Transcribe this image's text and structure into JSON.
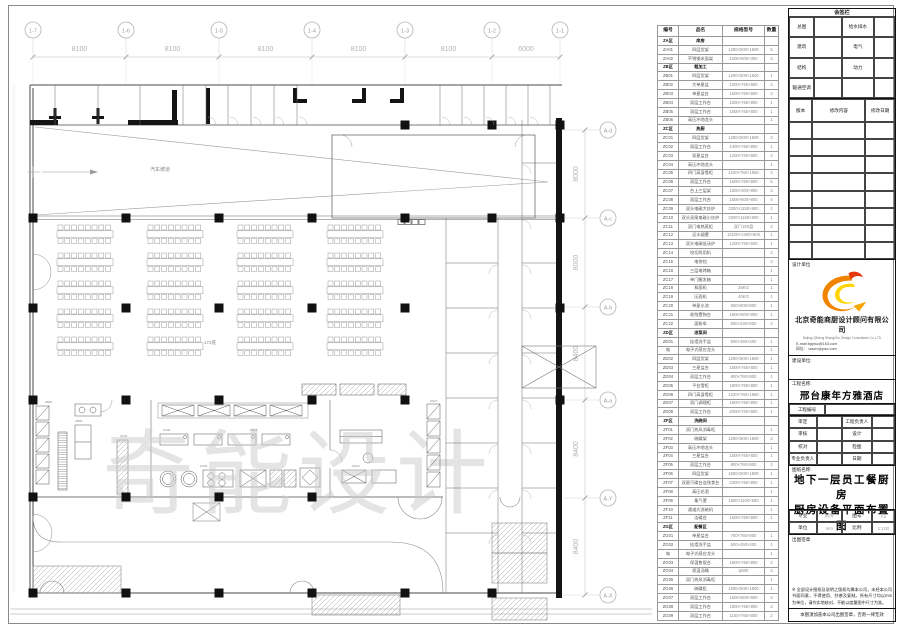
{
  "plan": {
    "grid_top": {
      "labels": [
        "1-7",
        "1-6",
        "1-5",
        "1-4",
        "1-3",
        "1-2",
        "1-1"
      ],
      "dims": [
        "8100",
        "8100",
        "8100",
        "8100",
        "8100",
        "6000"
      ]
    },
    "grid_right": {
      "labels": [
        "A-d",
        "A-c",
        "A-b",
        "A-a",
        "A-Y",
        "A-X"
      ],
      "dims": [
        "8000",
        "8000",
        "8400",
        "8400",
        "8400"
      ]
    },
    "watermark": "奇能设计",
    "ramp_label": "汽车坡道",
    "seats_label": "172座",
    "equip_tags": [
      "ZC06",
      "ZC09",
      "ZC05",
      "ZB02",
      "ZG03",
      "ZC12",
      "ZB03",
      "ZG07"
    ]
  },
  "schedule": {
    "headers": [
      "编号",
      "品名",
      "规格型号",
      "数量"
    ],
    "rows": [
      [
        "ZA区",
        "库房",
        "",
        "",
        true
      ],
      [
        "ZA01",
        "四层货架",
        "1200×500×1600",
        "5"
      ],
      [
        "ZA02",
        "不锈钢米面架",
        "1200×600×300",
        "4"
      ],
      [
        "ZB区",
        "粗加工",
        "",
        "",
        true
      ],
      [
        "ZB01",
        "四层货架",
        "1200×500×1600",
        "1"
      ],
      [
        "ZB02",
        "大单星盆",
        "1000×760×800",
        "4"
      ],
      [
        "ZB03",
        "单星盆台",
        "1500×760×800",
        "2"
      ],
      [
        "ZB04",
        "双层工作台",
        "1500×760×800",
        "1"
      ],
      [
        "ZB05",
        "双层工作台",
        "1800×760×800",
        "1"
      ],
      [
        "ZB06",
        "高压冲地龙头",
        "",
        "1"
      ],
      [
        "ZC区",
        "热厨",
        "",
        "",
        true
      ],
      [
        "ZC01",
        "四层货架",
        "1200×500×1600",
        "3"
      ],
      [
        "ZC02",
        "双层工作台",
        "1400×760×800",
        "1"
      ],
      [
        "ZC03",
        "双星盆台",
        "1200×760×800",
        "2"
      ],
      [
        "ZC04",
        "高压冲地龙头",
        "",
        "1"
      ],
      [
        "ZC05",
        "四门高身雪柜",
        "1220×760×1950",
        "4"
      ],
      [
        "ZC06",
        "双层工作台",
        "1600×760×800",
        "6"
      ],
      [
        "ZC07",
        "台上三层架",
        "1600×300×900",
        "3"
      ],
      [
        "ZC08",
        "双层工作台",
        "1600×600×800",
        "4"
      ],
      [
        "ZC09",
        "双头电磁大炒炉",
        "2200×1150×800",
        "1"
      ],
      [
        "ZC10",
        "双头双尾电磁小炒炉",
        "2200×1150×800",
        "1"
      ],
      [
        "ZC11",
        "双门电热蒸柜",
        "双门150盘",
        "2"
      ],
      [
        "ZC12",
        "运水烟罩",
        "14100×1300×600",
        "1"
      ],
      [
        "ZC13",
        "双头电磁低汤炉",
        "1200×750×600",
        "1"
      ],
      [
        "ZC14",
        "绞切两用机",
        "",
        "2"
      ],
      [
        "ZC15",
        "电饼铛",
        "",
        "2"
      ],
      [
        "ZC16",
        "三层电烤箱",
        "",
        "1"
      ],
      [
        "ZC17",
        "单门醒发箱",
        "",
        "1"
      ],
      [
        "ZC18",
        "和面机",
        "25KG",
        "1"
      ],
      [
        "ZC19",
        "压面机",
        "40KG",
        "1"
      ],
      [
        "ZC20",
        "单星水池",
        "600×600×800",
        "1"
      ],
      [
        "ZC21",
        "收残置物台",
        "1800×800×800",
        "1"
      ],
      [
        "ZC22",
        "面粉车",
        "500×430×600",
        "2"
      ],
      [
        "ZD区",
        "凉菜间",
        "",
        "",
        true
      ],
      [
        "ZD01",
        "挂墙洗手盆",
        "500×450×400",
        "1"
      ],
      [
        "电",
        "电子式感应龙头",
        "",
        "1"
      ],
      [
        "ZD02",
        "四层货架",
        "1200×500×1600",
        "1"
      ],
      [
        "ZD03",
        "三星盆台",
        "1800×760×800",
        "1"
      ],
      [
        "ZD04",
        "双层工作台",
        "900×760×800",
        "1"
      ],
      [
        "ZD05",
        "平台雪柜",
        "1800×760×800",
        "1"
      ],
      [
        "ZD06",
        "四门高身雪柜",
        "1220×760×1950",
        "1"
      ],
      [
        "ZD07",
        "双门调理柜",
        "1800×760×800",
        "1"
      ],
      [
        "ZD08",
        "双层工作台",
        "2000×760×800",
        "1"
      ],
      [
        "ZF区",
        "洗碗间",
        "",
        "",
        true
      ],
      [
        "ZF01",
        "双门热风消毒柜",
        "",
        "1"
      ],
      [
        "ZF02",
        "碗碟架",
        "1200×500×1800",
        "2"
      ],
      [
        "ZF03",
        "高压冲地龙头",
        "",
        "1"
      ],
      [
        "ZF04",
        "三星盆台",
        "1800×760×800",
        "1"
      ],
      [
        "ZF05",
        "双层工作台",
        "900×760×800",
        "2"
      ],
      [
        "ZF06",
        "四层货架",
        "1500×500×1800",
        "1"
      ],
      [
        "ZF07",
        "双星污碟台连残食台",
        "2300×760×800",
        "1"
      ],
      [
        "ZF08",
        "高压花洒",
        "",
        "1"
      ],
      [
        "ZF09",
        "集气罩",
        "1500×1100×500",
        "1"
      ],
      [
        "ZF10",
        "通道式洗碗机",
        "",
        "1"
      ],
      [
        "ZF11",
        "洁碟台",
        "1500×760×800",
        "1"
      ],
      [
        "ZG区",
        "配餐区",
        "",
        "",
        true
      ],
      [
        "ZG01",
        "单星盆台",
        "700×760×800",
        "1"
      ],
      [
        "ZG02",
        "挂墙洗手盆",
        "500×450×400",
        "1"
      ],
      [
        "电",
        "电子式感应龙头",
        "",
        "1"
      ],
      [
        "ZG03",
        "保温售饭台",
        "1800×760×800",
        "2"
      ],
      [
        "ZG04",
        "保温汤桶",
        "φ500",
        "4"
      ],
      [
        "ZG05",
        "双门热风消毒柜",
        "",
        "1"
      ],
      [
        "ZG06",
        "碗碟柜",
        "1200×500×1800",
        "1"
      ],
      [
        "ZG07",
        "双层工作台",
        "1500×800×800",
        "4"
      ],
      [
        "ZG08",
        "双层工作台",
        "1800×760×800",
        "2"
      ],
      [
        "ZG09",
        "双层工作台",
        "1150×760×800",
        "2"
      ]
    ]
  },
  "titleblock": {
    "sign_title": "会签栏",
    "sign_rows": [
      [
        "总图",
        "给水排水"
      ],
      [
        "建筑",
        "电气"
      ],
      [
        "结构",
        "动力"
      ],
      [
        "暖通空调",
        ""
      ]
    ],
    "rev_headers": [
      "版本",
      "修改内容",
      "修改日期"
    ],
    "design_unit_label": "设计单位",
    "company_cn": "北京奇能商厨设计顾问有限公司",
    "company_en": "Beijing QiNeng ShangChu Design Consultants Co.,LTD",
    "email": "E-mail:bjqnsc@163.com",
    "website": "网址： www.bjqnsc.com",
    "build_unit_label": "建设单位:",
    "project_label": "工程名称:",
    "project_name": "邢台康年方雅酒店",
    "project_no_label": "工程编号",
    "approval_rows": [
      [
        "审定",
        "工程负责人"
      ],
      [
        "审核",
        "设计"
      ],
      [
        "校对",
        "检图"
      ],
      [
        "专业负责人",
        "日期"
      ]
    ],
    "drawing_label": "图纸名称:",
    "drawing_title_line1": "地下一层员工餐厨房",
    "drawing_title_line2": "厨房设备平面布置图",
    "meta": {
      "major_label": "专业",
      "major": "厨房",
      "fig_label": "图号",
      "fig": "A1",
      "unit_label": "单位",
      "unit": "mm",
      "scale_label": "比例",
      "scale": "1:100"
    },
    "seal_label": "出图签章",
    "note": "※ 全部设计图纸及说明之版权均属本公司，未经本公司书面同意，不得使用、抄袭及复制。所有尺寸均以mm为单位，请作实地核对，不能以度量图中尺寸为准。",
    "footer_note": "本图须加盖本公司出图签章，否则一律无效",
    "colors": {
      "logo_orange": "#f08300",
      "logo_yellow": "#ffd400",
      "logo_red": "#e8380d"
    }
  }
}
